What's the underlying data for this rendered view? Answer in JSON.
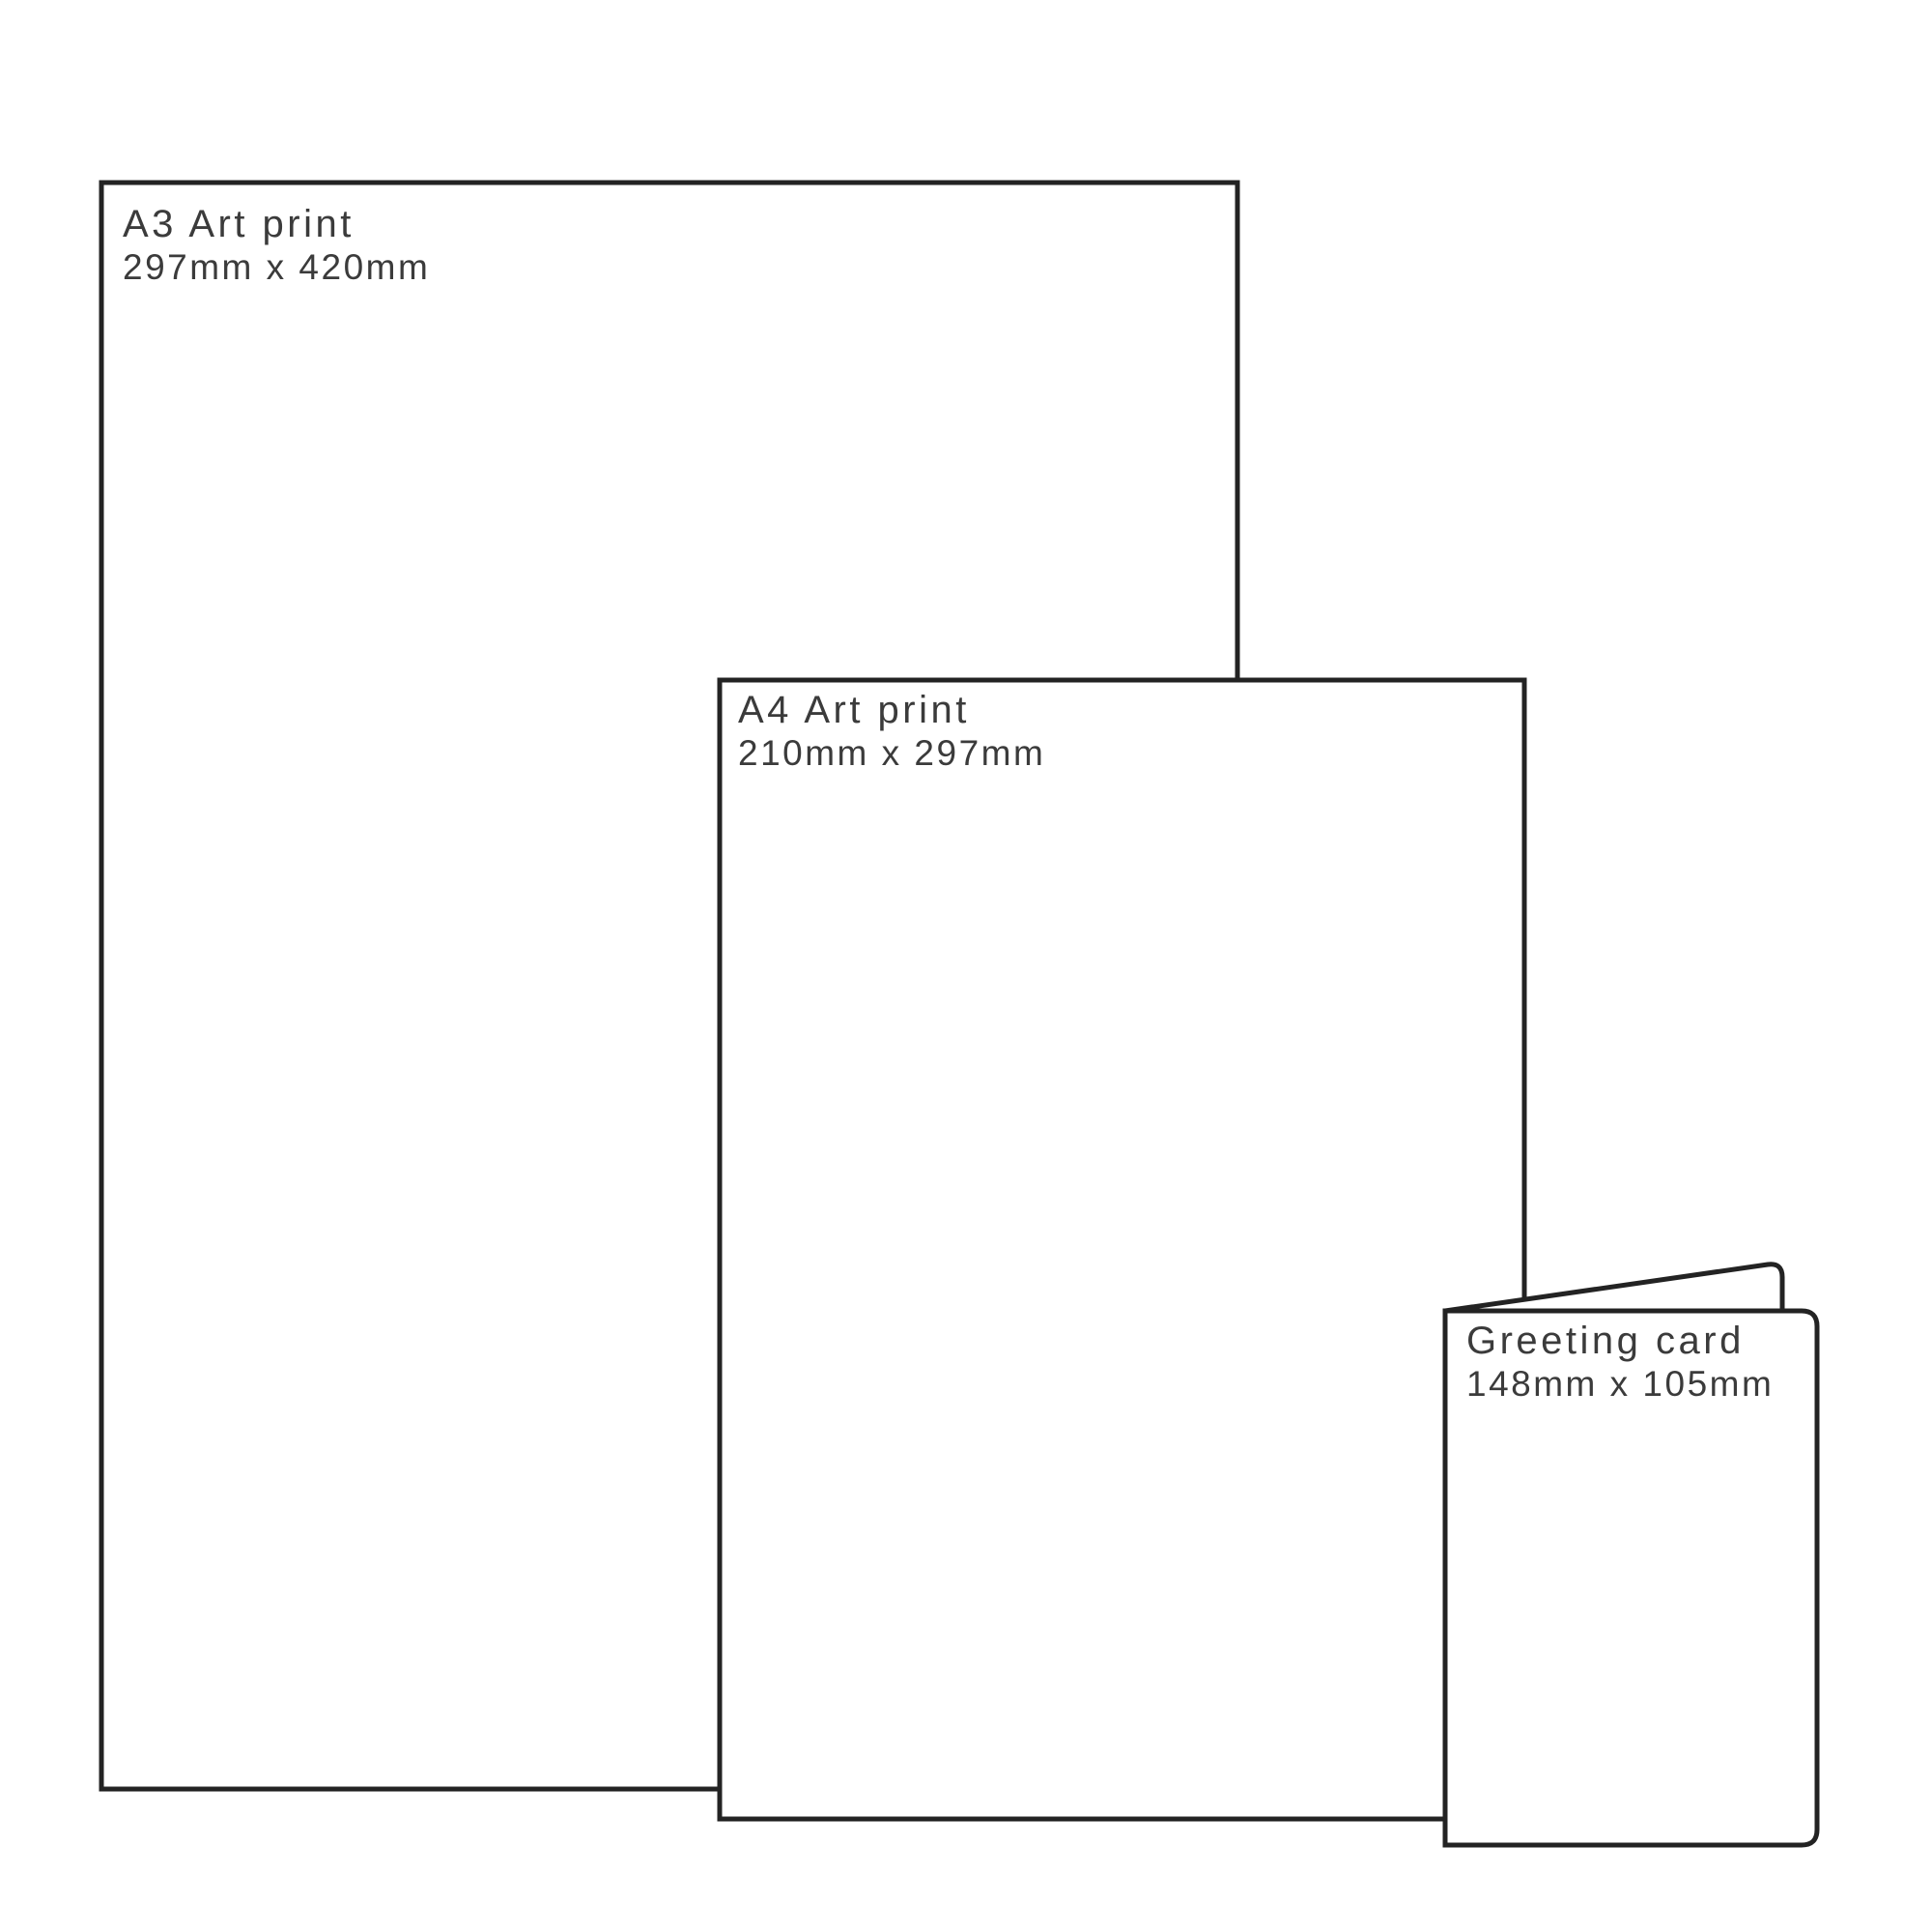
{
  "canvas": {
    "background": "#ffffff",
    "border_color": "#232323",
    "text_color": "#3b3b3b"
  },
  "items": [
    {
      "id": "a3-print",
      "title": "A3 Art print",
      "dimensions": "297mm x 420mm"
    },
    {
      "id": "a4-print",
      "title": "A4 Art print",
      "dimensions": "210mm x 297mm"
    },
    {
      "id": "greeting-card",
      "title": "Greeting card",
      "dimensions": "148mm x 105mm"
    }
  ]
}
